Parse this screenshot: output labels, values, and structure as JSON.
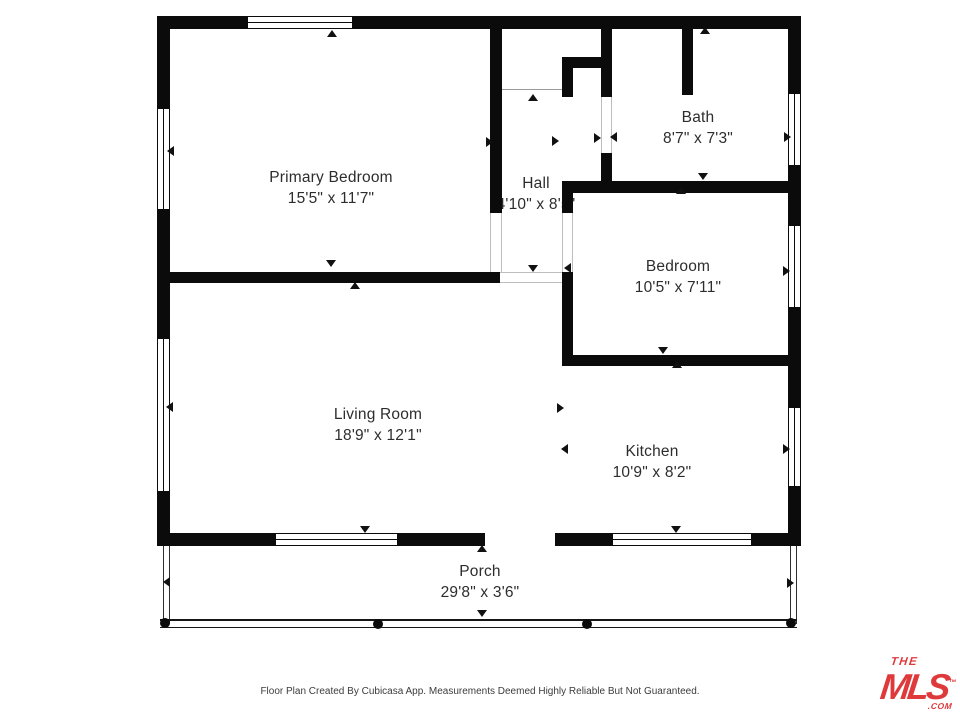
{
  "floor_plan": {
    "rooms": [
      {
        "name": "Primary Bedroom",
        "dimensions": "15'5\" x 11'7\""
      },
      {
        "name": "Hall",
        "dimensions": "4'10\" x 8'5\""
      },
      {
        "name": "Bath",
        "dimensions": "8'7\" x 7'3\""
      },
      {
        "name": "Bedroom",
        "dimensions": "10'5\" x 7'11\""
      },
      {
        "name": "Living Room",
        "dimensions": "18'9\" x 12'1\""
      },
      {
        "name": "Kitchen",
        "dimensions": "10'9\" x 8'2\""
      },
      {
        "name": "Porch",
        "dimensions": "29'8\" x 3'6\""
      }
    ],
    "footer": {
      "disclaimer": "Floor Plan Created By Cubicasa App. Measurements Deemed Highly Reliable But Not Guaranteed."
    },
    "logo": {
      "word_the": "THE",
      "word_mls": "MLS",
      "trademark": "™",
      "word_com": ".COM",
      "color": "#DE3A3C"
    }
  }
}
